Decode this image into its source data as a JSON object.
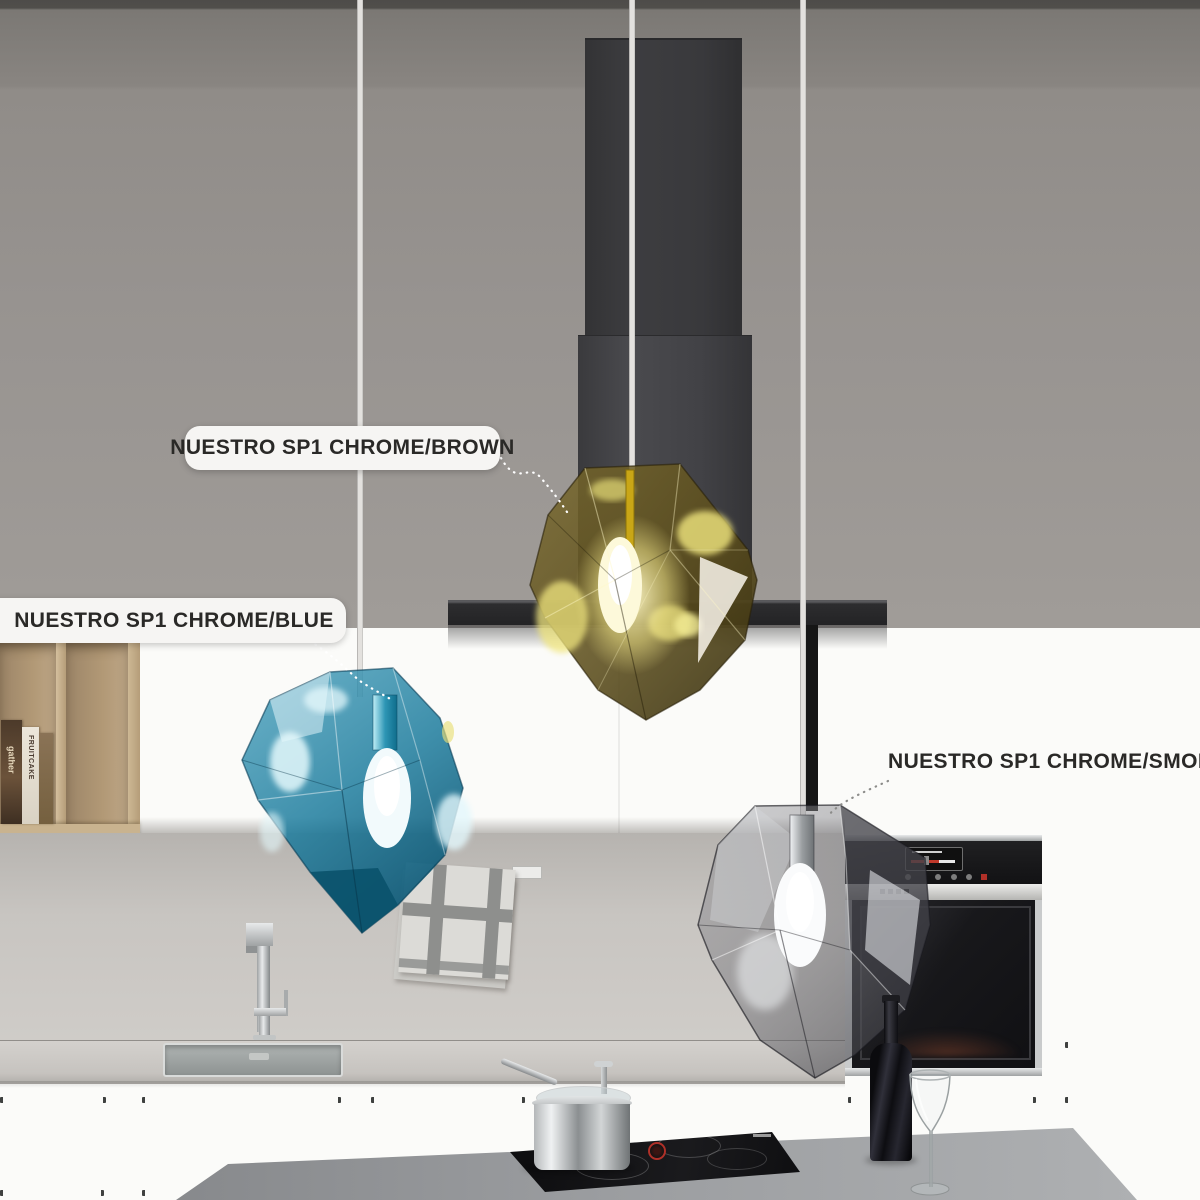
{
  "product_labels": {
    "brown": "NUESTRO SP1 CHROME/BROWN",
    "blue": "NUESTRO SP1 CHROME/BLUE",
    "smoke": "NUESTRO SP1 CHROME/SMOKE"
  },
  "shelf_books": {
    "book1_title": "gather",
    "book2_title": "FRUITCAKE"
  },
  "colors": {
    "brown_glass": "#6d5a1e",
    "blue_glass": "#1e7d9e",
    "smoke_glass": "#6a6a70",
    "label_pill": "#f6f5f3",
    "label_text": "#2a2927",
    "oven_accent_red": "#c0392b"
  }
}
